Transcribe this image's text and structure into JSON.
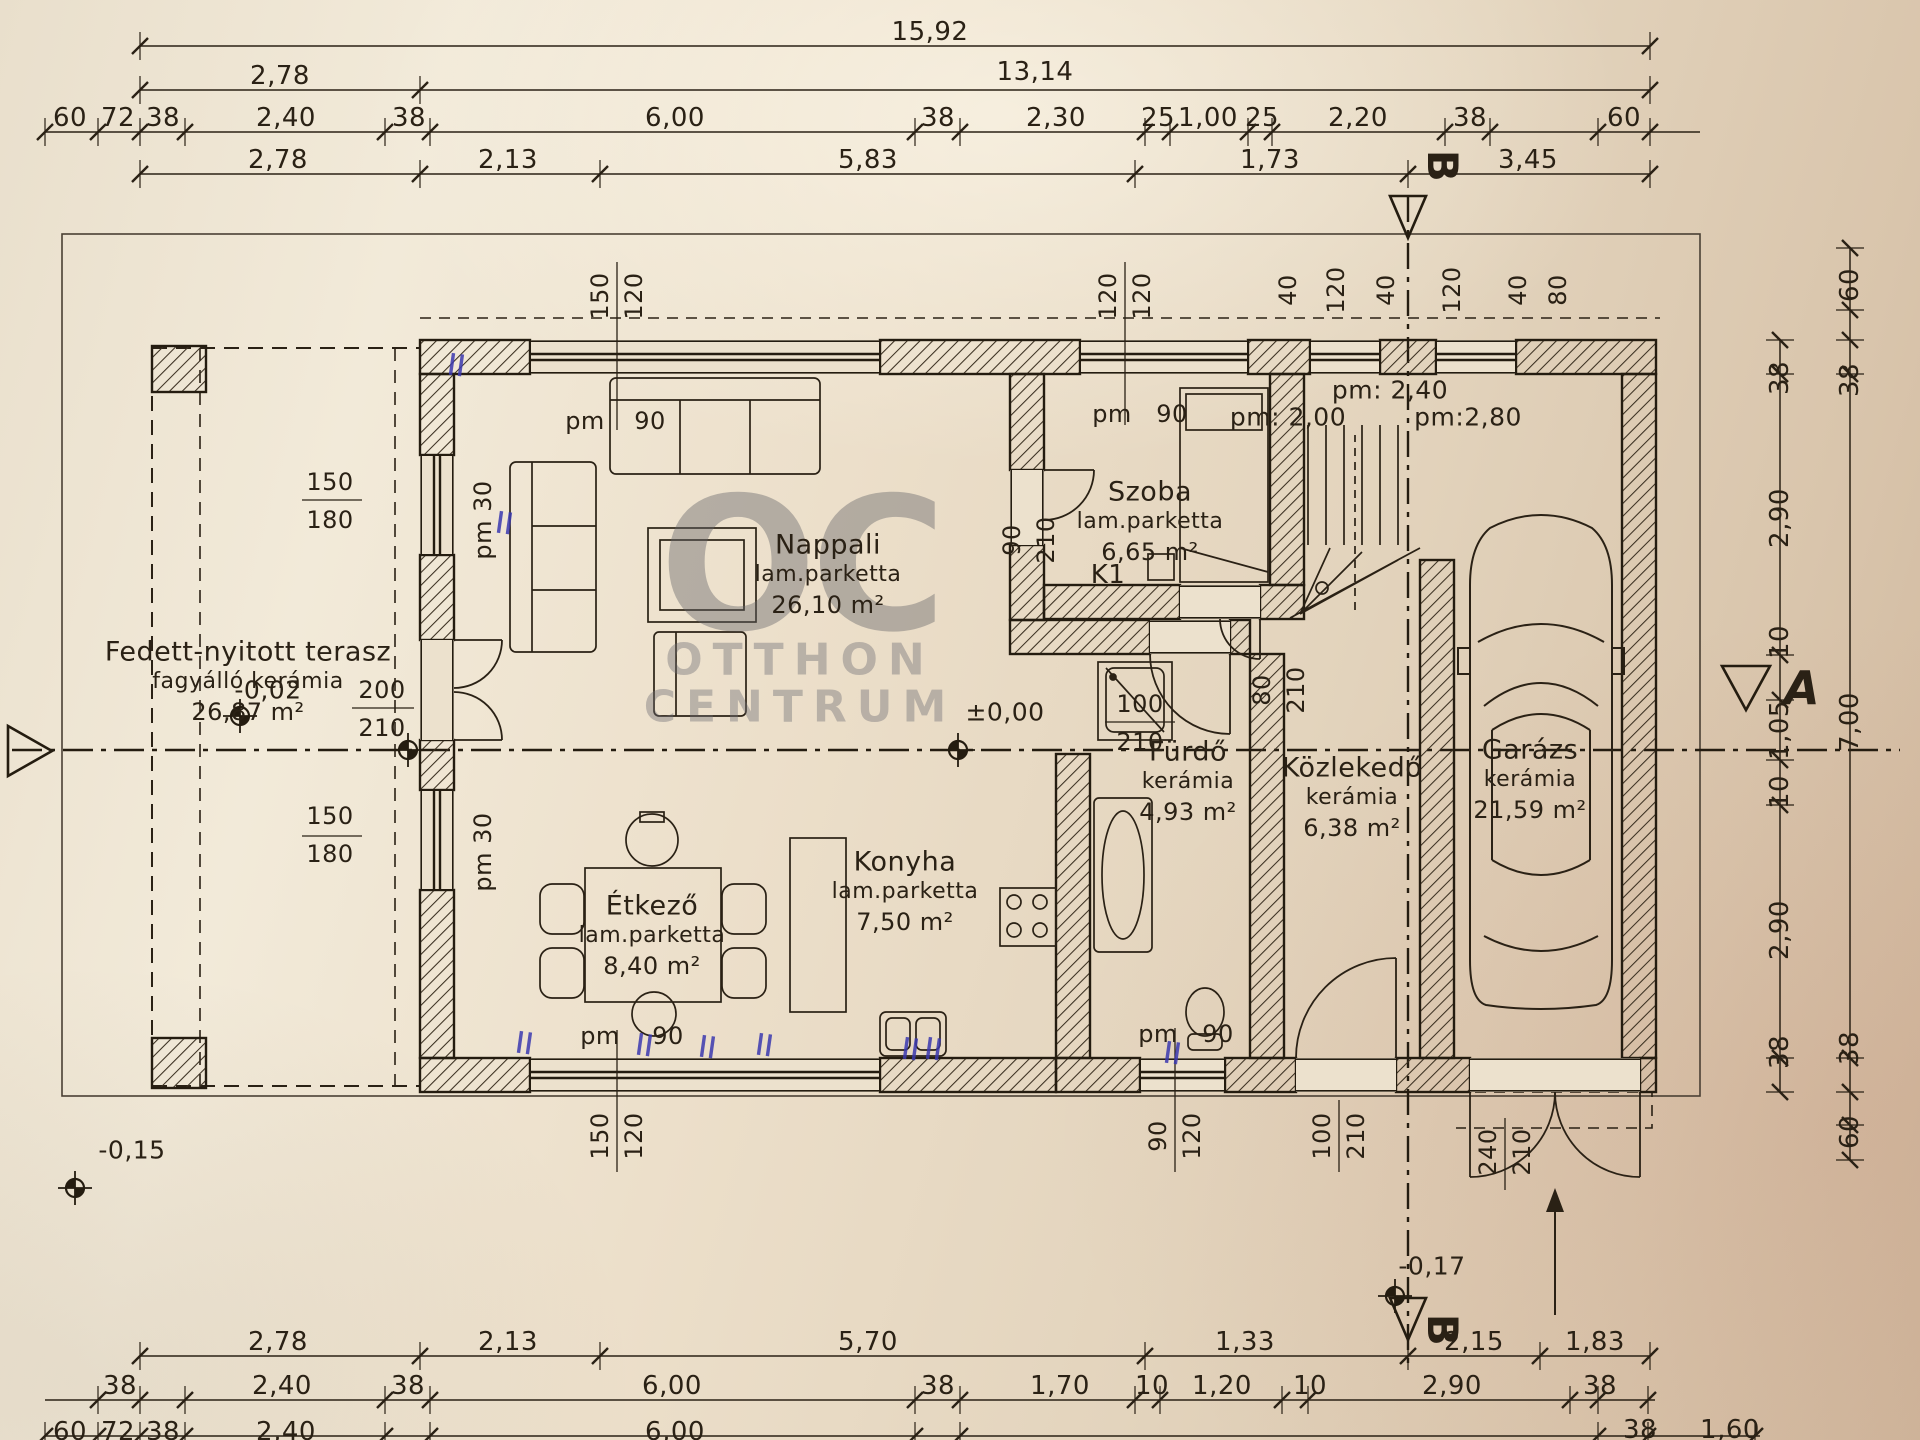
{
  "document": {
    "type": "floor-plan-scan",
    "language": "hu"
  },
  "watermark": {
    "logo": "OC",
    "line1": "OTTHON",
    "line2": "CENTRUM"
  },
  "rooms": [
    {
      "name": "Fedett-nyitott terasz",
      "floor": "fagyálló kerámia",
      "area": "26,87 m²",
      "x": 248,
      "y": 652
    },
    {
      "name": "Nappali",
      "floor": "lam.parketta",
      "area": "26,10 m²",
      "x": 828,
      "y": 545
    },
    {
      "name": "Szoba",
      "floor": "lam.parketta",
      "area": "6,65 m²",
      "x": 1150,
      "y": 492
    },
    {
      "name": "Étkező",
      "floor": "lam.parketta",
      "area": "8,40 m²",
      "x": 652,
      "y": 906
    },
    {
      "name": "Konyha",
      "floor": "lam.parketta",
      "area": "7,50 m²",
      "x": 905,
      "y": 862
    },
    {
      "name": "Fürdő",
      "floor": "kerámia",
      "area": "4,93 m²",
      "x": 1188,
      "y": 752
    },
    {
      "name": "Közlekedő",
      "floor": "kerámia",
      "area": "6,38 m²",
      "x": 1352,
      "y": 768
    },
    {
      "name": "Garázs",
      "floor": "kerámia",
      "area": "21,59 m²",
      "x": 1530,
      "y": 750
    }
  ],
  "texts": [
    {
      "t": "15,92",
      "x": 930,
      "y": 32,
      "n": "dim-label"
    },
    {
      "t": "2,78",
      "x": 280,
      "y": 76,
      "n": "dim-label"
    },
    {
      "t": "13,14",
      "x": 1035,
      "y": 72,
      "n": "dim-label"
    },
    {
      "t": "60",
      "x": 70,
      "y": 118,
      "n": "dim-label"
    },
    {
      "t": "72",
      "x": 118,
      "y": 118,
      "n": "dim-label"
    },
    {
      "t": "38",
      "x": 163,
      "y": 118,
      "n": "dim-label"
    },
    {
      "t": "2,40",
      "x": 286,
      "y": 118,
      "n": "dim-label"
    },
    {
      "t": "38",
      "x": 409,
      "y": 118,
      "n": "dim-label"
    },
    {
      "t": "6,00",
      "x": 675,
      "y": 118,
      "n": "dim-label"
    },
    {
      "t": "38",
      "x": 938,
      "y": 118,
      "n": "dim-label"
    },
    {
      "t": "2,30",
      "x": 1056,
      "y": 118,
      "n": "dim-label"
    },
    {
      "t": "25",
      "x": 1158,
      "y": 118,
      "n": "dim-label"
    },
    {
      "t": "1,00",
      "x": 1208,
      "y": 118,
      "n": "dim-label"
    },
    {
      "t": "25",
      "x": 1262,
      "y": 118,
      "n": "dim-label"
    },
    {
      "t": "2,20",
      "x": 1358,
      "y": 118,
      "n": "dim-label"
    },
    {
      "t": "38",
      "x": 1470,
      "y": 118,
      "n": "dim-label"
    },
    {
      "t": "60",
      "x": 1624,
      "y": 118,
      "n": "dim-label"
    },
    {
      "t": "2,78",
      "x": 278,
      "y": 160,
      "n": "dim-label"
    },
    {
      "t": "2,13",
      "x": 508,
      "y": 160,
      "n": "dim-label"
    },
    {
      "t": "5,83",
      "x": 868,
      "y": 160,
      "n": "dim-label"
    },
    {
      "t": "1,73",
      "x": 1270,
      "y": 160,
      "n": "dim-label"
    },
    {
      "t": "3,45",
      "x": 1528,
      "y": 160,
      "n": "dim-label"
    },
    {
      "t": "2,78",
      "x": 278,
      "y": 1342,
      "n": "dim-label"
    },
    {
      "t": "2,13",
      "x": 508,
      "y": 1342,
      "n": "dim-label"
    },
    {
      "t": "5,70",
      "x": 868,
      "y": 1342,
      "n": "dim-label"
    },
    {
      "t": "1,33",
      "x": 1245,
      "y": 1342,
      "n": "dim-label"
    },
    {
      "t": "2,15",
      "x": 1474,
      "y": 1342,
      "n": "dim-label"
    },
    {
      "t": "1,83",
      "x": 1595,
      "y": 1342,
      "n": "dim-label"
    },
    {
      "t": "38",
      "x": 120,
      "y": 1386,
      "n": "dim-label"
    },
    {
      "t": "2,40",
      "x": 282,
      "y": 1386,
      "n": "dim-label"
    },
    {
      "t": "38",
      "x": 408,
      "y": 1386,
      "n": "dim-label"
    },
    {
      "t": "6,00",
      "x": 672,
      "y": 1386,
      "n": "dim-label"
    },
    {
      "t": "38",
      "x": 938,
      "y": 1386,
      "n": "dim-label"
    },
    {
      "t": "1,70",
      "x": 1060,
      "y": 1386,
      "n": "dim-label"
    },
    {
      "t": "10",
      "x": 1152,
      "y": 1386,
      "n": "dim-label"
    },
    {
      "t": "1,20",
      "x": 1222,
      "y": 1386,
      "n": "dim-label"
    },
    {
      "t": "10",
      "x": 1310,
      "y": 1386,
      "n": "dim-label"
    },
    {
      "t": "2,90",
      "x": 1452,
      "y": 1386,
      "n": "dim-label"
    },
    {
      "t": "38",
      "x": 1600,
      "y": 1386,
      "n": "dim-label"
    },
    {
      "t": "60",
      "x": 70,
      "y": 1432,
      "n": "dim-label"
    },
    {
      "t": "72",
      "x": 118,
      "y": 1432,
      "n": "dim-label"
    },
    {
      "t": "38",
      "x": 163,
      "y": 1432,
      "n": "dim-label"
    },
    {
      "t": "2,40",
      "x": 286,
      "y": 1432,
      "n": "dim-label"
    },
    {
      "t": "6,00",
      "x": 675,
      "y": 1432,
      "n": "dim-label"
    },
    {
      "t": "38",
      "x": 1640,
      "y": 1430,
      "n": "dim-label"
    },
    {
      "t": "1,60",
      "x": 1730,
      "y": 1430,
      "n": "dim-label"
    },
    {
      "t": "38",
      "x": 1780,
      "y": 378,
      "r": -90,
      "n": "dim-label"
    },
    {
      "t": "2,90",
      "x": 1780,
      "y": 518,
      "r": -90,
      "n": "dim-label"
    },
    {
      "t": "10",
      "x": 1780,
      "y": 642,
      "r": -90,
      "n": "dim-label"
    },
    {
      "t": "1,05",
      "x": 1780,
      "y": 730,
      "r": -90,
      "n": "dim-label"
    },
    {
      "t": "10",
      "x": 1780,
      "y": 792,
      "r": -90,
      "n": "dim-label"
    },
    {
      "t": "2,90",
      "x": 1780,
      "y": 930,
      "r": -90,
      "n": "dim-label"
    },
    {
      "t": "38",
      "x": 1780,
      "y": 1052,
      "r": -90,
      "n": "dim-label"
    },
    {
      "t": "60",
      "x": 1850,
      "y": 285,
      "r": -90,
      "n": "dim-label"
    },
    {
      "t": "38",
      "x": 1850,
      "y": 380,
      "r": -90,
      "n": "dim-label"
    },
    {
      "t": "7,00",
      "x": 1850,
      "y": 722,
      "r": -90,
      "n": "dim-label"
    },
    {
      "t": "38",
      "x": 1850,
      "y": 1048,
      "r": -90,
      "n": "dim-label"
    },
    {
      "t": "60",
      "x": 1850,
      "y": 1132,
      "r": -90,
      "n": "dim-label"
    },
    {
      "t": "150",
      "x": 600,
      "y": 296,
      "r": -90,
      "s": 24,
      "n": "opening-label"
    },
    {
      "t": "120",
      "x": 634,
      "y": 296,
      "r": -90,
      "s": 24,
      "n": "opening-label"
    },
    {
      "t": "120",
      "x": 1108,
      "y": 296,
      "r": -90,
      "s": 24,
      "n": "opening-label"
    },
    {
      "t": "120",
      "x": 1142,
      "y": 296,
      "r": -90,
      "s": 24,
      "n": "opening-label"
    },
    {
      "t": "40",
      "x": 1288,
      "y": 290,
      "r": -90,
      "s": 24,
      "n": "opening-label"
    },
    {
      "t": "120",
      "x": 1336,
      "y": 290,
      "r": -90,
      "s": 24,
      "n": "opening-label"
    },
    {
      "t": "40",
      "x": 1386,
      "y": 290,
      "r": -90,
      "s": 24,
      "n": "opening-label"
    },
    {
      "t": "120",
      "x": 1452,
      "y": 290,
      "r": -90,
      "s": 24,
      "n": "opening-label"
    },
    {
      "t": "40",
      "x": 1518,
      "y": 290,
      "r": -90,
      "s": 24,
      "n": "opening-label"
    },
    {
      "t": "80",
      "x": 1558,
      "y": 290,
      "r": -90,
      "s": 24,
      "n": "opening-label"
    },
    {
      "t": "pm: 2,40",
      "x": 1390,
      "y": 390,
      "s": 25,
      "n": "opening-label"
    },
    {
      "t": "pm: 2,00",
      "x": 1288,
      "y": 417,
      "s": 25,
      "n": "opening-label"
    },
    {
      "t": "pm:2,80",
      "x": 1468,
      "y": 417,
      "s": 25,
      "n": "opening-label"
    },
    {
      "t": "150",
      "x": 330,
      "y": 482,
      "s": 24,
      "n": "opening-label"
    },
    {
      "t": "180",
      "x": 330,
      "y": 520,
      "s": 24,
      "n": "opening-label"
    },
    {
      "t": "pm 30",
      "x": 483,
      "y": 520,
      "r": -90,
      "s": 24,
      "n": "opening-label"
    },
    {
      "t": "200",
      "x": 382,
      "y": 690,
      "s": 24,
      "n": "opening-label"
    },
    {
      "t": "210",
      "x": 382,
      "y": 728,
      "s": 24,
      "n": "opening-label"
    },
    {
      "t": "150",
      "x": 330,
      "y": 816,
      "s": 24,
      "n": "opening-label"
    },
    {
      "t": "180",
      "x": 330,
      "y": 854,
      "s": 24,
      "n": "opening-label"
    },
    {
      "t": "pm 30",
      "x": 483,
      "y": 852,
      "r": -90,
      "s": 24,
      "n": "opening-label"
    },
    {
      "t": "pm",
      "x": 585,
      "y": 421,
      "s": 24,
      "n": "opening-label"
    },
    {
      "t": "90",
      "x": 650,
      "y": 421,
      "s": 24,
      "n": "opening-label"
    },
    {
      "t": "pm",
      "x": 1112,
      "y": 414,
      "s": 24,
      "n": "opening-label"
    },
    {
      "t": "90",
      "x": 1172,
      "y": 414,
      "s": 24,
      "n": "opening-label"
    },
    {
      "t": "K1",
      "x": 1108,
      "y": 575,
      "s": 26,
      "n": "opening-label"
    },
    {
      "t": "90",
      "x": 1012,
      "y": 540,
      "r": -90,
      "s": 24,
      "n": "opening-label"
    },
    {
      "t": "210",
      "x": 1046,
      "y": 540,
      "r": -90,
      "s": 24,
      "n": "opening-label"
    },
    {
      "t": "100",
      "x": 1140,
      "y": 704,
      "s": 24,
      "n": "opening-label"
    },
    {
      "t": "210",
      "x": 1140,
      "y": 742,
      "s": 24,
      "n": "opening-label"
    },
    {
      "t": "±0,00",
      "x": 1005,
      "y": 712,
      "s": 25,
      "n": "level-label"
    },
    {
      "t": "80",
      "x": 1262,
      "y": 690,
      "r": -90,
      "s": 24,
      "n": "opening-label"
    },
    {
      "t": "210",
      "x": 1296,
      "y": 690,
      "r": -90,
      "s": 24,
      "n": "opening-label"
    },
    {
      "t": "pm",
      "x": 600,
      "y": 1036,
      "s": 24,
      "n": "opening-label"
    },
    {
      "t": "90",
      "x": 668,
      "y": 1036,
      "s": 24,
      "n": "opening-label"
    },
    {
      "t": "pm",
      "x": 1158,
      "y": 1034,
      "s": 24,
      "n": "opening-label"
    },
    {
      "t": "90",
      "x": 1218,
      "y": 1034,
      "s": 24,
      "n": "opening-label"
    },
    {
      "t": "150",
      "x": 600,
      "y": 1136,
      "r": -90,
      "s": 24,
      "n": "opening-label"
    },
    {
      "t": "120",
      "x": 634,
      "y": 1136,
      "r": -90,
      "s": 24,
      "n": "opening-label"
    },
    {
      "t": "90",
      "x": 1158,
      "y": 1136,
      "r": -90,
      "s": 24,
      "n": "opening-label"
    },
    {
      "t": "120",
      "x": 1192,
      "y": 1136,
      "r": -90,
      "s": 24,
      "n": "opening-label"
    },
    {
      "t": "100",
      "x": 1322,
      "y": 1136,
      "r": -90,
      "s": 24,
      "n": "opening-label"
    },
    {
      "t": "210",
      "x": 1356,
      "y": 1136,
      "r": -90,
      "s": 24,
      "n": "opening-label"
    },
    {
      "t": "240",
      "x": 1488,
      "y": 1152,
      "r": -90,
      "s": 24,
      "n": "opening-label"
    },
    {
      "t": "210",
      "x": 1522,
      "y": 1152,
      "r": -90,
      "s": 24,
      "n": "opening-label"
    },
    {
      "t": "-0,02",
      "x": 268,
      "y": 690,
      "s": 25,
      "n": "level-label"
    },
    {
      "t": "-0,15",
      "x": 132,
      "y": 1150,
      "s": 25,
      "n": "level-label"
    },
    {
      "t": "-0,17",
      "x": 1432,
      "y": 1266,
      "s": 25,
      "n": "level-label"
    },
    {
      "t": "B",
      "x": 1442,
      "y": 166,
      "r": 90,
      "s": 42,
      "b": 1,
      "n": "section-label-b"
    },
    {
      "t": "B",
      "x": 1442,
      "y": 1330,
      "r": 90,
      "s": 42,
      "b": 1,
      "n": "section-label-b"
    },
    {
      "t": "A",
      "x": 1802,
      "y": 688,
      "s": 46,
      "b": 1,
      "i": 1,
      "n": "section-label-a"
    }
  ]
}
